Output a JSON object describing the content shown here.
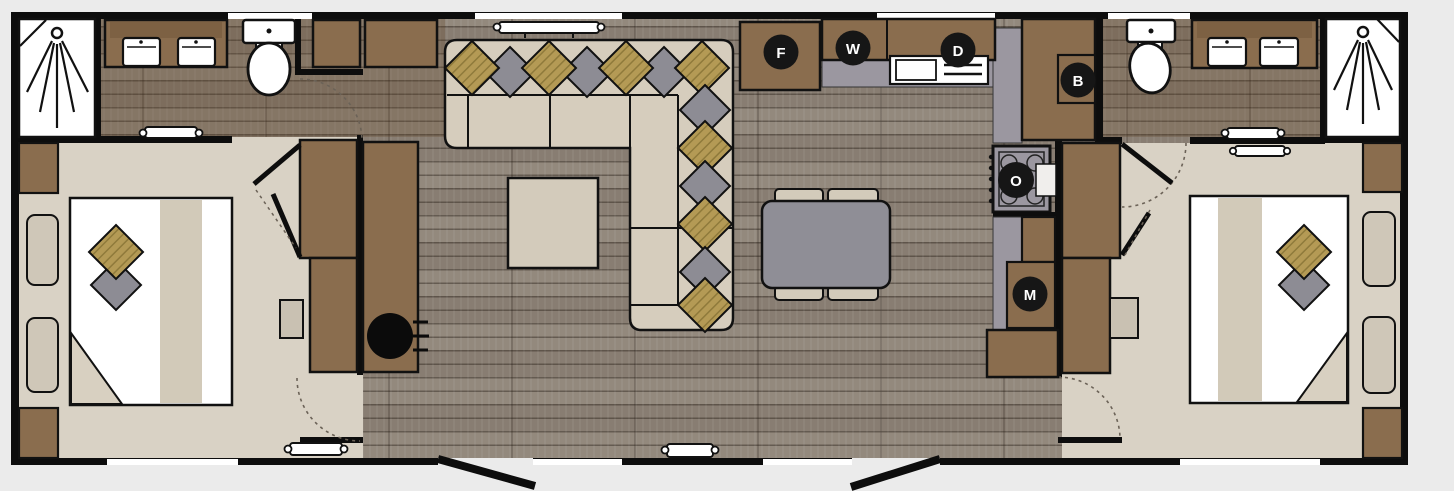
{
  "plan": {
    "type": "floorplan",
    "markers": [
      {
        "letter": "F",
        "x": 781,
        "y": 52
      },
      {
        "letter": "W",
        "x": 853,
        "y": 48
      },
      {
        "letter": "D",
        "x": 958,
        "y": 50
      },
      {
        "letter": "B",
        "x": 1078,
        "y": 80
      },
      {
        "letter": "O",
        "x": 1016,
        "y": 180
      },
      {
        "letter": "M",
        "x": 1030,
        "y": 294
      }
    ],
    "colors": {
      "background": "#ebebeb",
      "wall": "#0d0d0d",
      "wood_floor": "#8f8478",
      "bathroom_floor_tint": "#6f5138",
      "bedroom_floor": "#d9d2c5",
      "cabinet_brown": "#8a6d4e",
      "upholstery_beige": "#d6cdbd",
      "cushion_grey": "#8d8c94",
      "cushion_tan": "#b49a55",
      "counter_grey": "#9b97a0",
      "marker_black": "#161616",
      "fixture_white": "#ffffff"
    }
  }
}
